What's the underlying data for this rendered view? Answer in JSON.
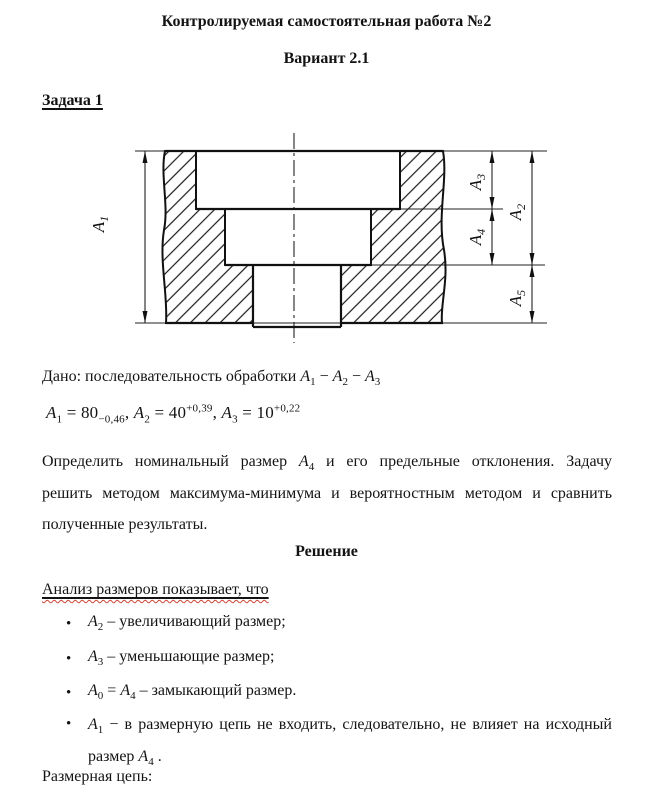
{
  "header": {
    "title": "Контролируемая самостоятельная работа №2",
    "variant": "Вариант 2.1",
    "task_label": "Задача 1"
  },
  "icons": {
    "bullet": "•"
  },
  "drawing": {
    "dims": [
      {
        "letter": "A",
        "sub": "1"
      },
      {
        "letter": "A",
        "sub": "2"
      },
      {
        "letter": "A",
        "sub": "3"
      },
      {
        "letter": "A",
        "sub": "4"
      },
      {
        "letter": "A",
        "sub": "5"
      }
    ]
  },
  "given": {
    "intro_tokens": [
      {
        "t": "text",
        "v": "Дано: последовательность обработки "
      },
      {
        "t": "var",
        "v": "A"
      },
      {
        "t": "sub",
        "v": "1"
      },
      {
        "t": "text",
        "v": " − "
      },
      {
        "t": "var",
        "v": "A"
      },
      {
        "t": "sub",
        "v": "2"
      },
      {
        "t": "text",
        "v": " − "
      },
      {
        "t": "var",
        "v": "A"
      },
      {
        "t": "sub",
        "v": "3"
      }
    ],
    "formula_tokens": [
      {
        "t": "var",
        "v": "A"
      },
      {
        "t": "sub",
        "v": "1"
      },
      {
        "t": "text",
        "v": " =  80"
      },
      {
        "t": "sub",
        "v": "−0,46"
      },
      {
        "t": "text",
        "v": ", "
      },
      {
        "t": "var",
        "v": "A"
      },
      {
        "t": "sub",
        "v": "2"
      },
      {
        "t": "text",
        "v": " =  40"
      },
      {
        "t": "sup",
        "v": "+0,39"
      },
      {
        "t": "text",
        "v": ", "
      },
      {
        "t": "var",
        "v": "A"
      },
      {
        "t": "sub",
        "v": "3"
      },
      {
        "t": "text",
        "v": " =  10"
      },
      {
        "t": "sup",
        "v": "+0,22"
      }
    ]
  },
  "task": {
    "line1_tokens": [
      {
        "t": "text",
        "v": "Определить номинальный размер "
      },
      {
        "t": "var",
        "v": "A"
      },
      {
        "t": "sub",
        "v": "4"
      },
      {
        "t": "text",
        "v": " и его предельные отклонения. Задачу"
      }
    ],
    "line2": "решить методом максимума-минимума и вероятностным методом и сравнить",
    "line3": "полученные результаты."
  },
  "solution": {
    "heading": "Решение",
    "analysis": "Анализ размеров показывает, что",
    "bullets": [
      {
        "tokens": [
          {
            "t": "var",
            "v": "A"
          },
          {
            "t": "sub",
            "v": "2"
          },
          {
            "t": "text",
            "v": " – увеличивающий размер;"
          }
        ]
      },
      {
        "tokens": [
          {
            "t": "var",
            "v": "A"
          },
          {
            "t": "sub",
            "v": "3"
          },
          {
            "t": "text",
            "v": "  – уменьшающие размер;"
          }
        ]
      },
      {
        "tokens": [
          {
            "t": "var",
            "v": "A"
          },
          {
            "t": "sub",
            "v": "0"
          },
          {
            "t": "text",
            "v": " = "
          },
          {
            "t": "var",
            "v": "A"
          },
          {
            "t": "sub",
            "v": "4"
          },
          {
            "t": "text",
            "v": " – замыкающий размер."
          }
        ]
      },
      {
        "tokens": [
          {
            "t": "var",
            "v": "A"
          },
          {
            "t": "sub",
            "v": "1"
          },
          {
            "t": "text",
            "v": "  −  в размерную цепь не входить, следовательно, не влияет на исходный размер "
          },
          {
            "t": "var",
            "v": "A"
          },
          {
            "t": "sub",
            "v": "4"
          },
          {
            "t": "text",
            "v": " ."
          }
        ]
      }
    ],
    "closing": "Размерная цепь:"
  }
}
